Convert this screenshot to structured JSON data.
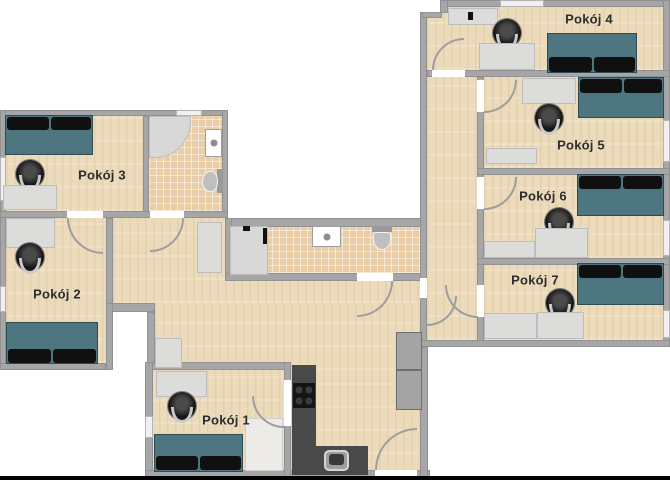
{
  "plan": {
    "type": "apartment-floor-plan",
    "language": "pl",
    "rooms": [
      {
        "id": "pokoj-1",
        "label": "Pokój 1"
      },
      {
        "id": "pokoj-2",
        "label": "Pokój 2"
      },
      {
        "id": "pokoj-3",
        "label": "Pokój 3"
      },
      {
        "id": "pokoj-4",
        "label": "Pokój 4"
      },
      {
        "id": "pokoj-5",
        "label": "Pokój 5"
      },
      {
        "id": "pokoj-6",
        "label": "Pokój 6"
      },
      {
        "id": "pokoj-7",
        "label": "Pokój 7"
      }
    ],
    "unlabeled_areas": [
      "bathroom-top",
      "bathroom-middle",
      "kitchen",
      "living-area",
      "corridor"
    ],
    "colors": {
      "wall": "#a6a6a6",
      "wood_floor": "#ecdbbb",
      "tile_floor": "#e9cda6",
      "bed": "#4d7680",
      "pillow": "#101010",
      "desk": "#dcdcda",
      "kitchen_counter": "#494949",
      "outside": "#ffffff"
    },
    "furniture_icons": [
      "bed",
      "pillow",
      "desk",
      "office-chair",
      "wardrobe",
      "shower",
      "toilet",
      "washbasin",
      "cooktop",
      "kitchen-sink",
      "hall-cabinet",
      "door-swing",
      "window"
    ]
  }
}
